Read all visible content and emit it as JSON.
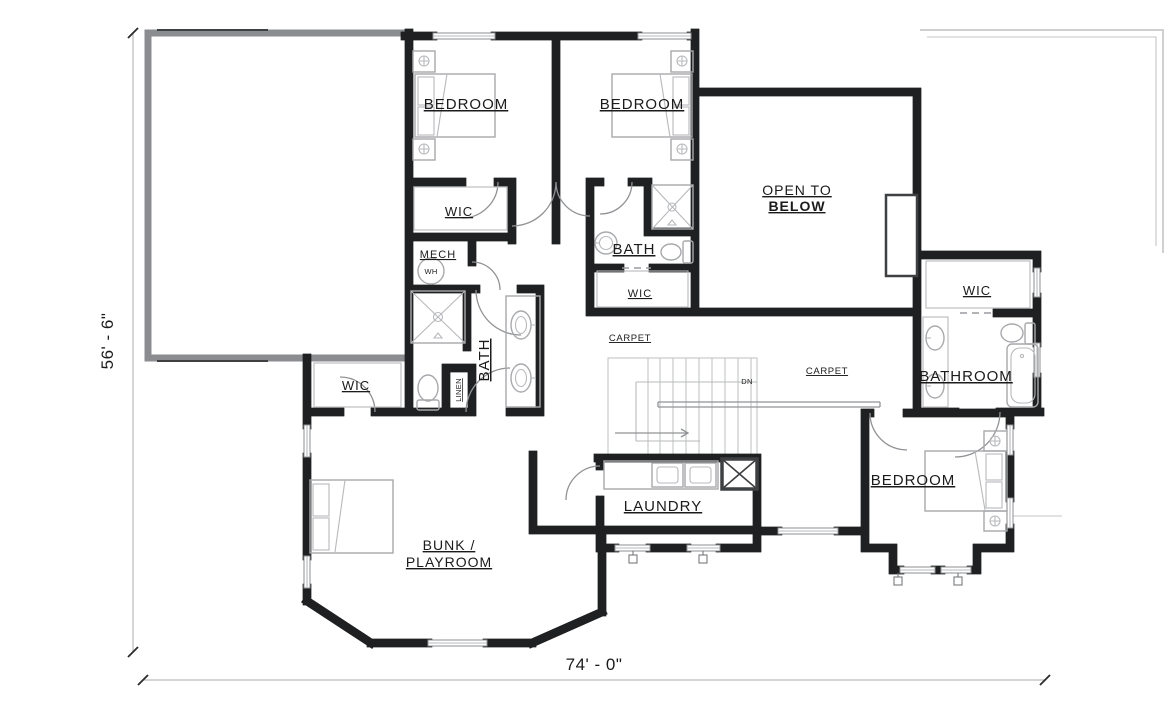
{
  "rooms": {
    "bedroom_top_left": "BEDROOM",
    "bedroom_top_right": "BEDROOM",
    "bedroom_bottom_right": "BEDROOM",
    "bunk_playroom_line1": "BUNK /",
    "bunk_playroom_line2": "PLAYROOM",
    "open_to_below_line1": "OPEN TO",
    "open_to_below_line2": "BELOW",
    "laundry": "LAUNDRY",
    "bathroom_right": "BATHROOM",
    "bath_center": "BATH",
    "bath_ensuite": "BATH",
    "wic_bedroom1": "WIC",
    "wic_ensuite": "WIC",
    "wic_right": "WIC",
    "wic_left": "WIC",
    "mech": "MECH",
    "linen": "LINEN",
    "water_heater": "WH",
    "carpet_left": "CARPET",
    "carpet_right": "CARPET"
  },
  "stairs": {
    "down_label": "DN"
  },
  "dimensions": {
    "left_vertical": "56' - 6\"",
    "bottom_horizontal": "74' - 0\""
  },
  "colors": {
    "wall_dark": "#5a5b5e",
    "wall_outline": "#1f2021",
    "wall_gray": "#8a8c8f",
    "fixture_line": "#a7a9ac",
    "dimension_line": "#b9babc",
    "text": "#1b1b1b",
    "background": "#ffffff"
  }
}
